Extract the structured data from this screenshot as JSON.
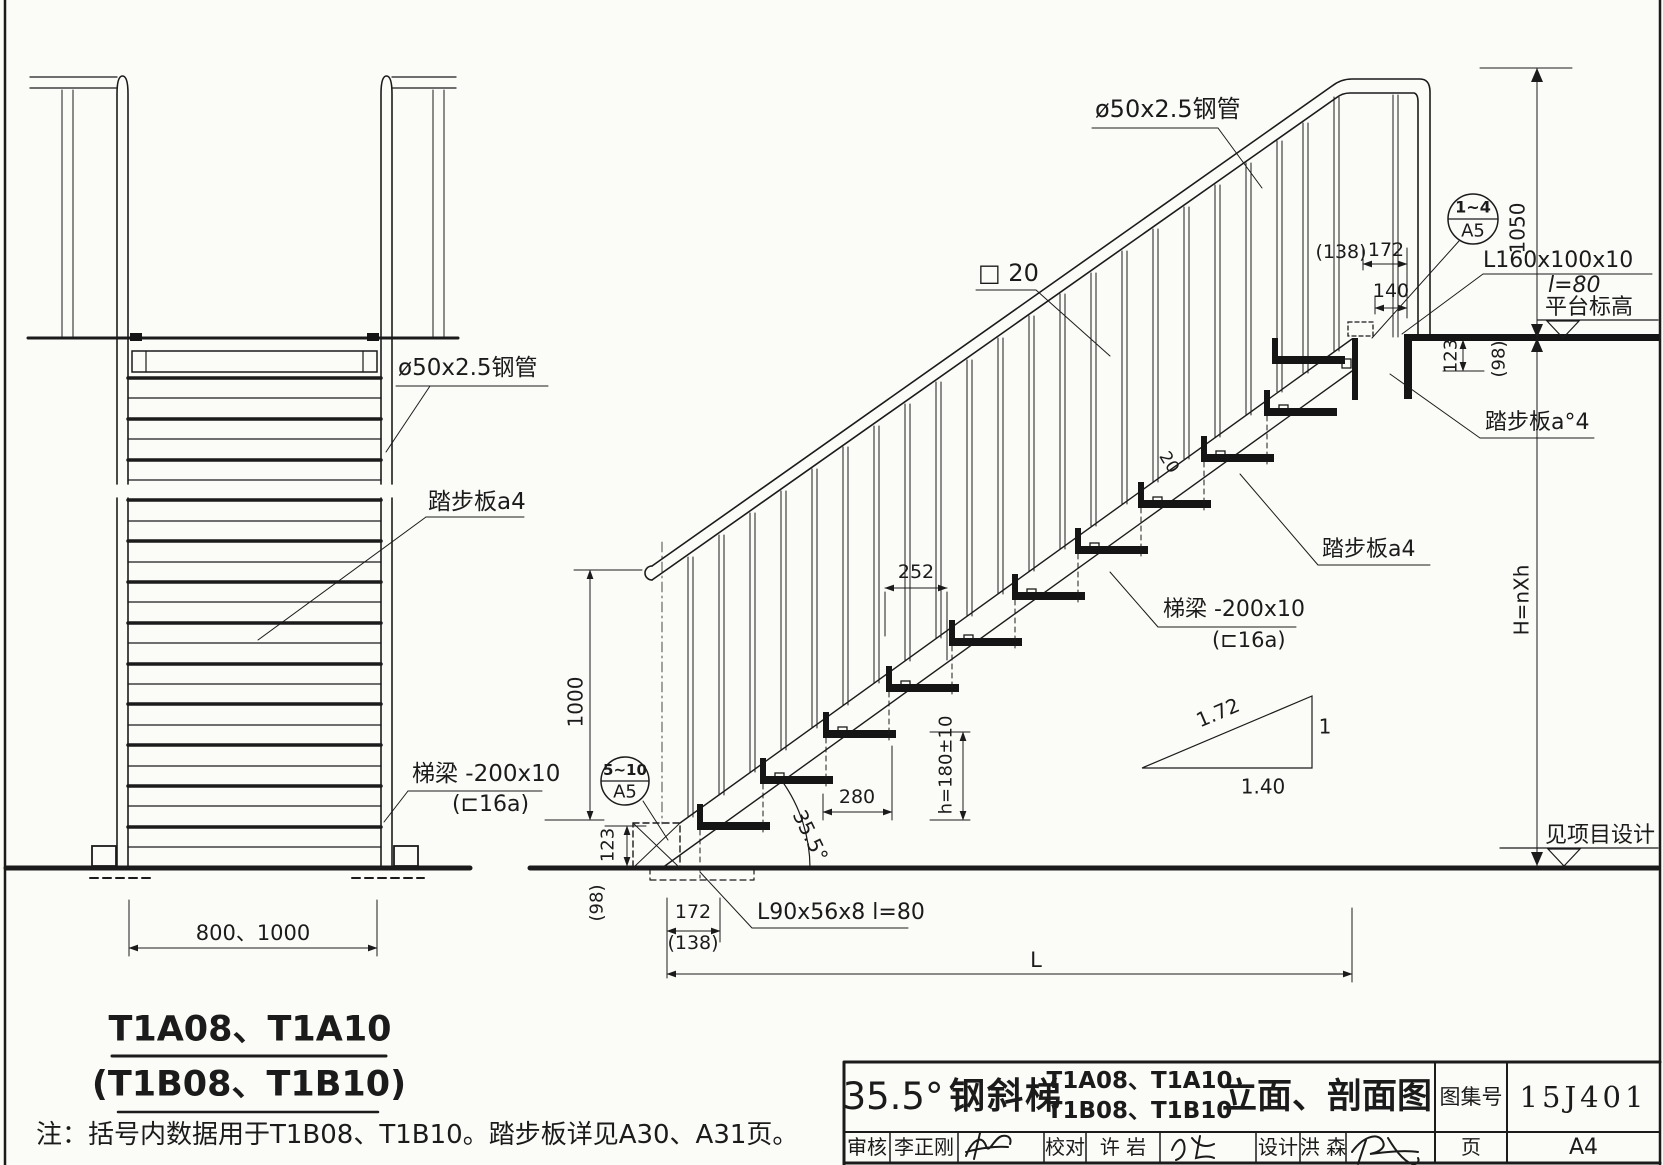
{
  "front_view": {
    "pipe_label": "ø50x2.5钢管",
    "tread_label": "踏步板a4",
    "stringer_label": "梯梁 -200x10",
    "stringer_channel": "(⊏16a)",
    "width_dim": "800、1000",
    "model_title": "T1A08、T1A10",
    "model_title_alt": "(T1B08、T1B10)"
  },
  "section_view": {
    "pipe_label": "ø50x2.5钢管",
    "baluster_label": "□ 20",
    "baluster_gap_dim": "20",
    "rail_height_dim": "1050",
    "total_height_dim": "H=nXh",
    "height_dim": "1000",
    "tread_plate_top": "踏步板a°4",
    "tread_plate": "踏步板a4",
    "stringer_label": "梯梁 -200x10",
    "stringer_channel": "(⊏16a)",
    "top_angle": "L160x100x10",
    "top_angle_len": "l=80",
    "platform_level": "平台标高",
    "bottom_angle": "L90x56x8  l=80",
    "ground_level": "见项目设计",
    "angle": "35.5°",
    "detail_top": {
      "ref": "1~4",
      "sheet": "A5"
    },
    "detail_bottom": {
      "ref": "5~10",
      "sheet": "A5"
    },
    "slope_triangle": {
      "hypotenuse": "1.72",
      "vertical": "1",
      "horizontal": "1.40"
    },
    "dims": {
      "offset_paren_top": "(138)",
      "offset_top": "172",
      "post_offset": "140",
      "rise_top": "123",
      "rise_top_paren": "(98)",
      "baluster_spacing": "252",
      "tread_run": "280",
      "step_rise": "h=180±10",
      "rise_bottom": "123",
      "rise_bottom_paren": "(98)",
      "offset_bottom": "172",
      "offset_paren_bottom": "(138)",
      "total_run": "L"
    }
  },
  "note": "注：括号内数据用于T1B08、T1B10。踏步板详见A30、A31页。",
  "title_block": {
    "angle": "35.5°",
    "name": "钢斜梯",
    "models_line1": "T1A08、T1A10",
    "models_line2": "T1B08、T1B10",
    "suffix": "立面、剖面图",
    "atlas_label": "图集号",
    "atlas_no": "15J401",
    "page_label": "页",
    "page_no": "A4",
    "review_label": "审核",
    "review_name": "李正刚",
    "check_label": "校对",
    "check_name": "许  岩",
    "design_label": "设计",
    "design_name": "洪  森"
  }
}
